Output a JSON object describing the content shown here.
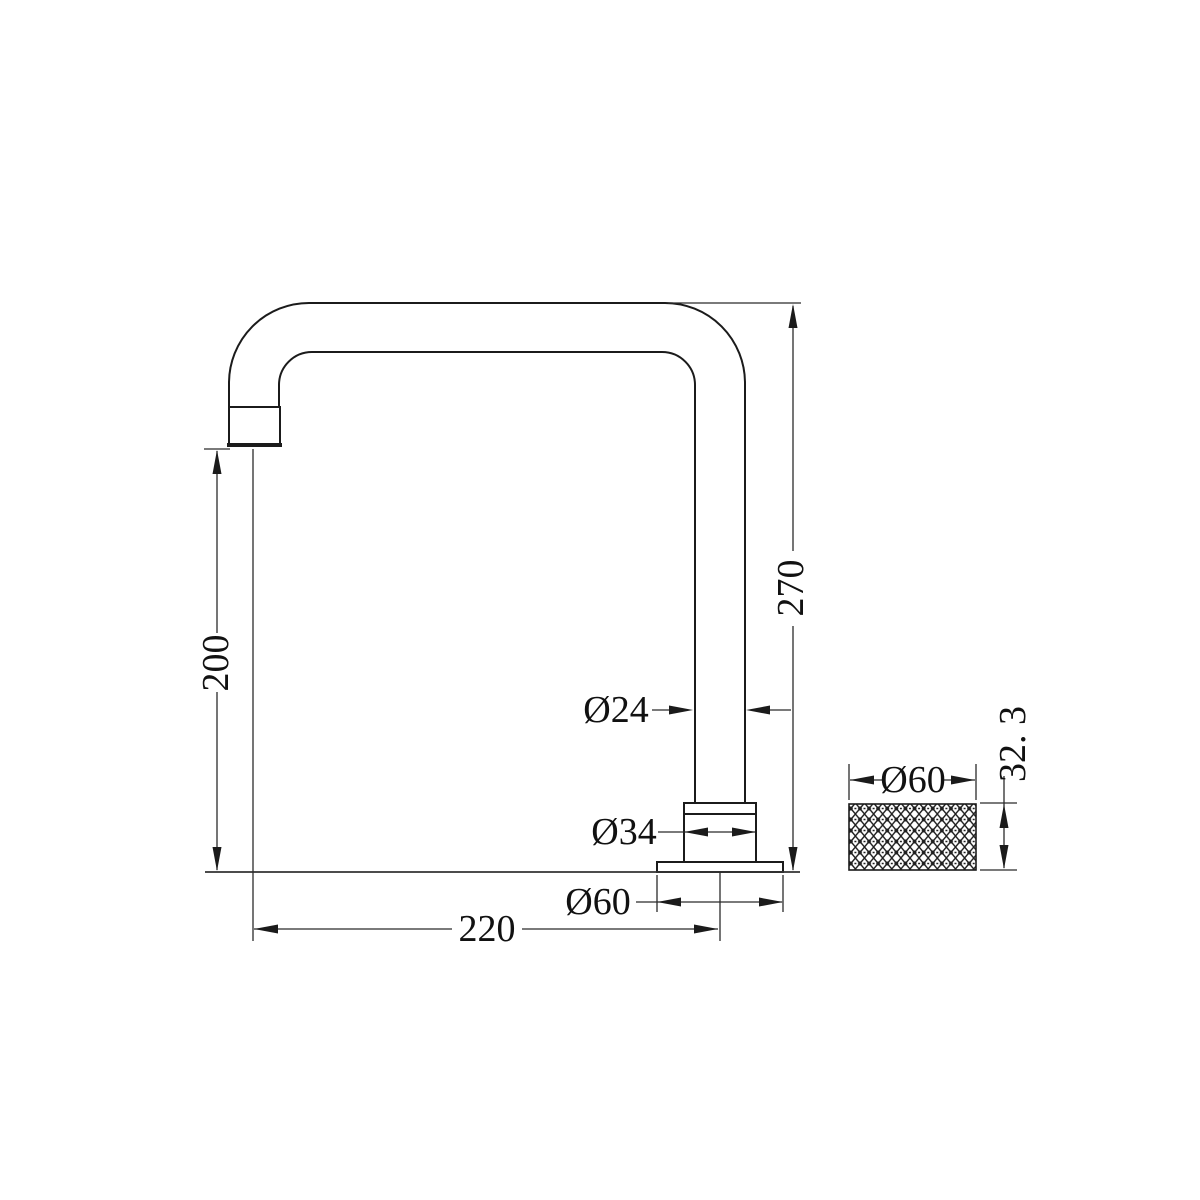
{
  "drawing": {
    "background_color": "#ffffff",
    "outline_color": "#1b1b1b",
    "dimension_line_color": "#2b2b2b",
    "text_color": "#111111"
  },
  "dimensions": {
    "spout_height": "200",
    "overall_height": "270",
    "spout_reach": "220",
    "spout_pipe_diameter": "Ø24",
    "collar_diameter": "Ø34",
    "base_flange_diameter": "Ø60",
    "handle_diameter": "Ø60",
    "handle_height": "32. 3"
  }
}
